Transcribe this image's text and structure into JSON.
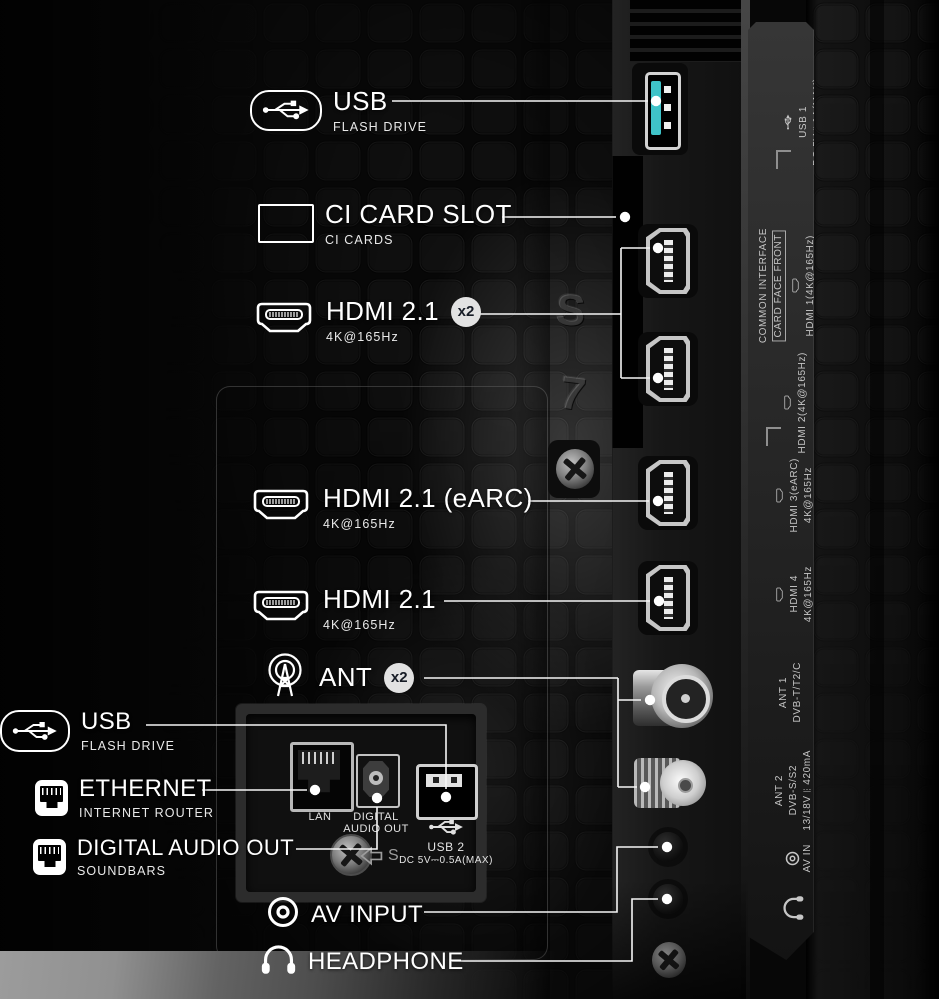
{
  "annotations": {
    "usb_top": {
      "title": "USB",
      "subtitle": "FLASH DRIVE"
    },
    "ci_slot": {
      "title": "CI CARD SLOT",
      "subtitle": "CI CARDS"
    },
    "hdmi_x2": {
      "title": "HDMI 2.1",
      "subtitle": "4K@165Hz",
      "badge": "x2"
    },
    "hdmi_earc": {
      "title": "HDMI 2.1 (eARC)",
      "subtitle": "4K@165Hz"
    },
    "hdmi_4": {
      "title": "HDMI 2.1",
      "subtitle": "4K@165Hz"
    },
    "ant": {
      "title": "ANT",
      "badge": "x2"
    },
    "usb_side": {
      "title": "USB",
      "subtitle": "FLASH DRIVE"
    },
    "ethernet": {
      "title": "ETHERNET",
      "subtitle": "INTERNET ROUTER"
    },
    "digital_audio": {
      "title": "DIGITAL AUDIO OUT",
      "subtitle": "SOUNDBARS"
    },
    "av_input": {
      "title": "AV INPUT"
    },
    "headphone": {
      "title": "HEADPHONE"
    }
  },
  "panel": {
    "lan": "LAN",
    "digital_audio_line1": "DIGITAL",
    "digital_audio_line2": "AUDIO OUT",
    "usb2": "USB 2",
    "usb2_power": "DC 5V⎓0.5A(MAX)",
    "s_mark": "S"
  },
  "side_strip": {
    "usb1": [
      "USB 1",
      "DC 5V⎓1A(MAX)"
    ],
    "common_interface": [
      "COMMON INTERFACE",
      "CARD FACE FRONT"
    ],
    "hdmi1": "HDMI 1(4K@165Hz)",
    "hdmi2": "HDMI 2(4K@165Hz)",
    "hdmi3": [
      "HDMI 3(eARC)",
      "4K@165Hz"
    ],
    "hdmi4": [
      "HDMI 4",
      "4K@165Hz"
    ],
    "ant1": [
      "ANT 1",
      "DVB-T/T2/C"
    ],
    "ant2": [
      "ANT 2",
      "DVB-S/S2",
      "13/18V⎓420mA"
    ],
    "av_in": "AV IN"
  },
  "molded": {
    "s": "S",
    "seven": "7"
  },
  "colors": {
    "usb3_tongue": "#3fc3c8",
    "badge_bg": "#e2e2e2",
    "badge_text": "#171c26",
    "leader": "#f5f5f5"
  }
}
